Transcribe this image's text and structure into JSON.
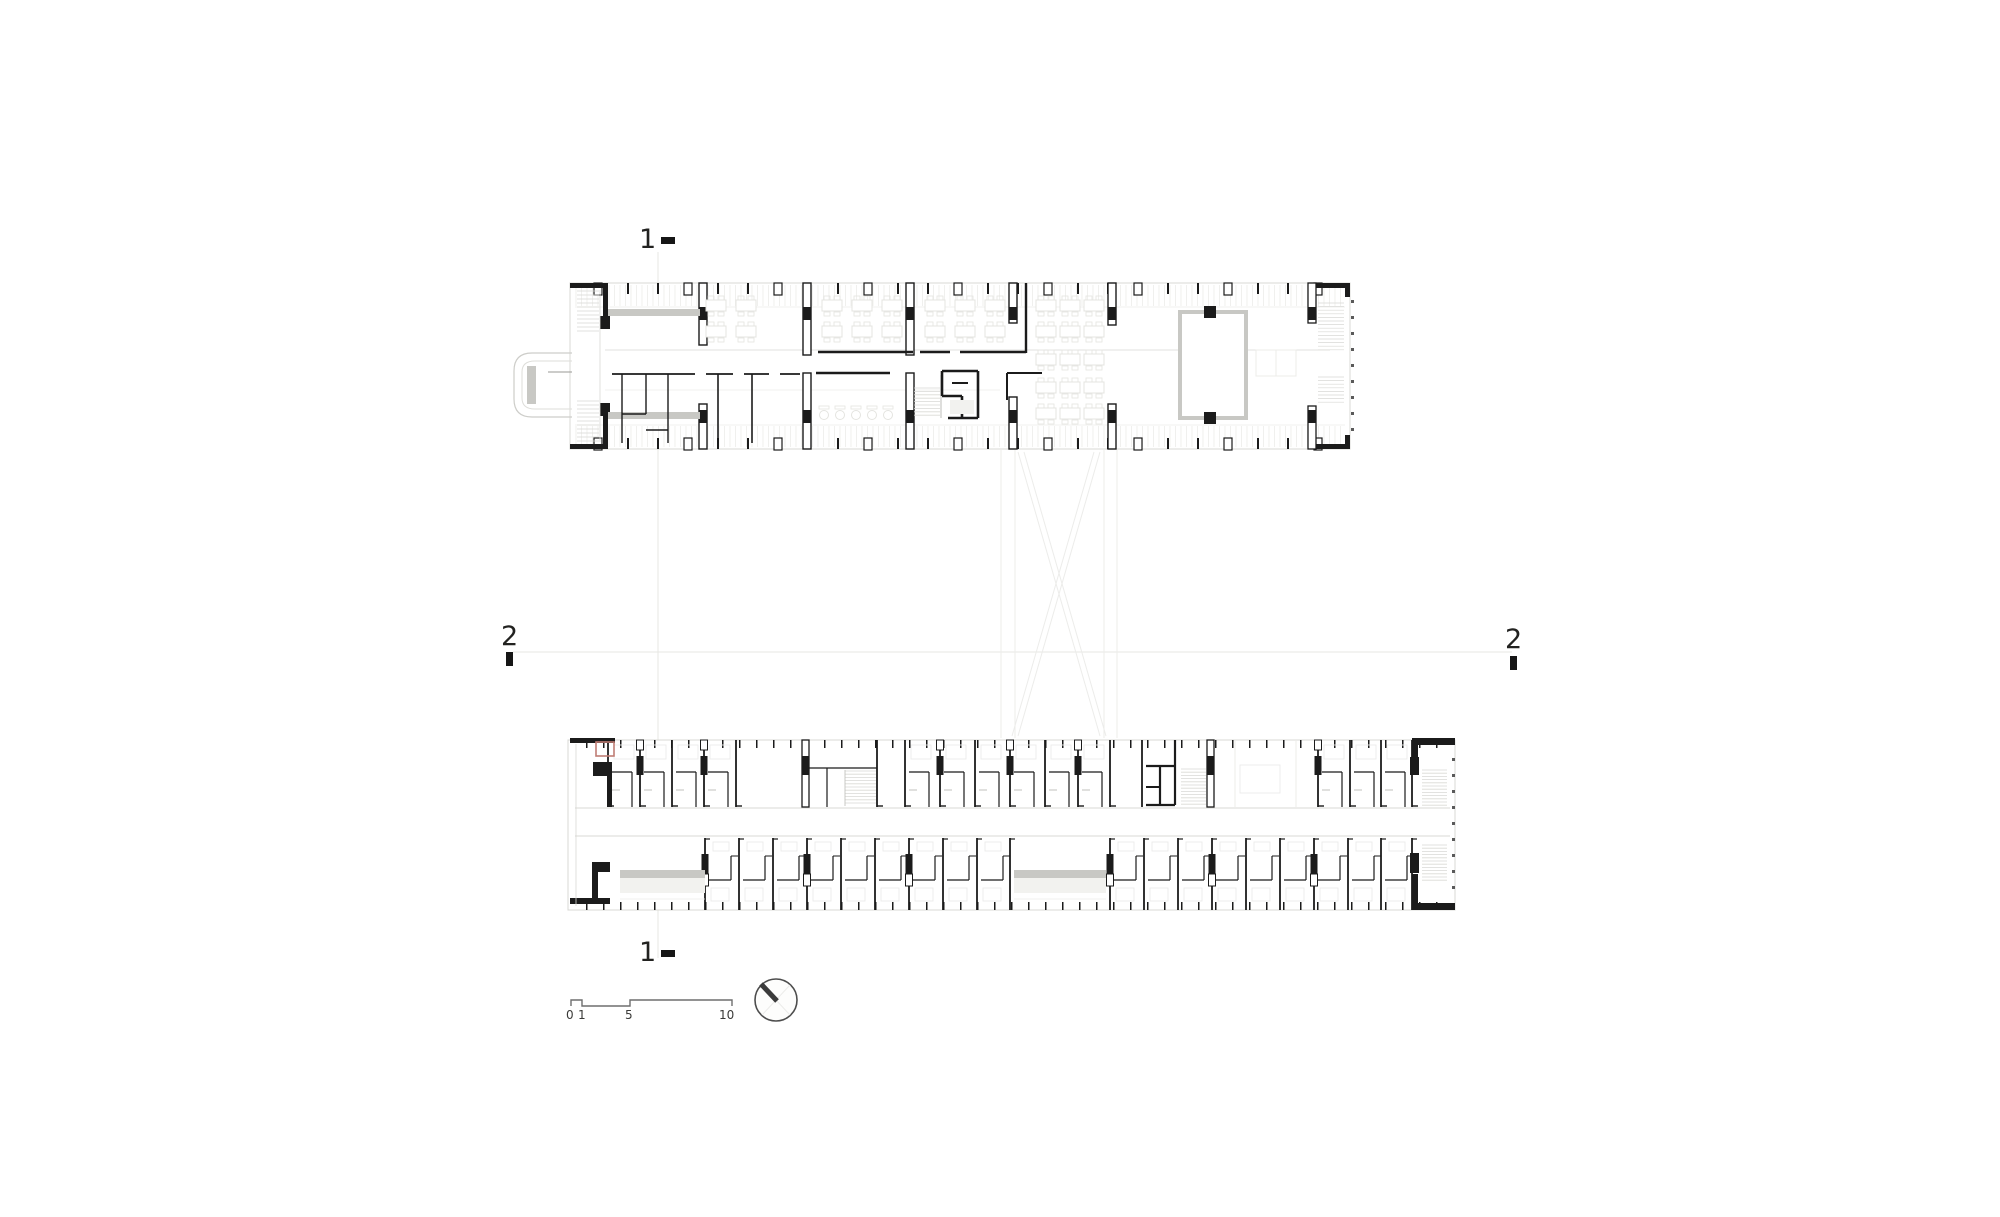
{
  "drawing": {
    "kind": "architectural-floor-plan",
    "section_markers": {
      "one_top": "1",
      "one_bottom": "1",
      "two_left": "2",
      "two_right": "2"
    },
    "scale_bar": {
      "labels": [
        "0",
        "1",
        "5",
        "10"
      ]
    },
    "icons": {
      "north_arrow": "north-arrow-icon"
    },
    "colors": {
      "background": "#ffffff",
      "wall": "#1b1b1b",
      "slab": "#d8d8d4",
      "faint": "#ececea",
      "hatch": "#d9d9d5",
      "furniture": "#e4e4e0",
      "walkway": "#c8c8c4",
      "accent_red": "#c07d74",
      "dots": "#5a5a5a",
      "scale_line": "#6e6e6e",
      "north_circle": "#4d4d4d",
      "north_needle": "#3b3b3b",
      "section_line": "#e7e7e3"
    }
  }
}
